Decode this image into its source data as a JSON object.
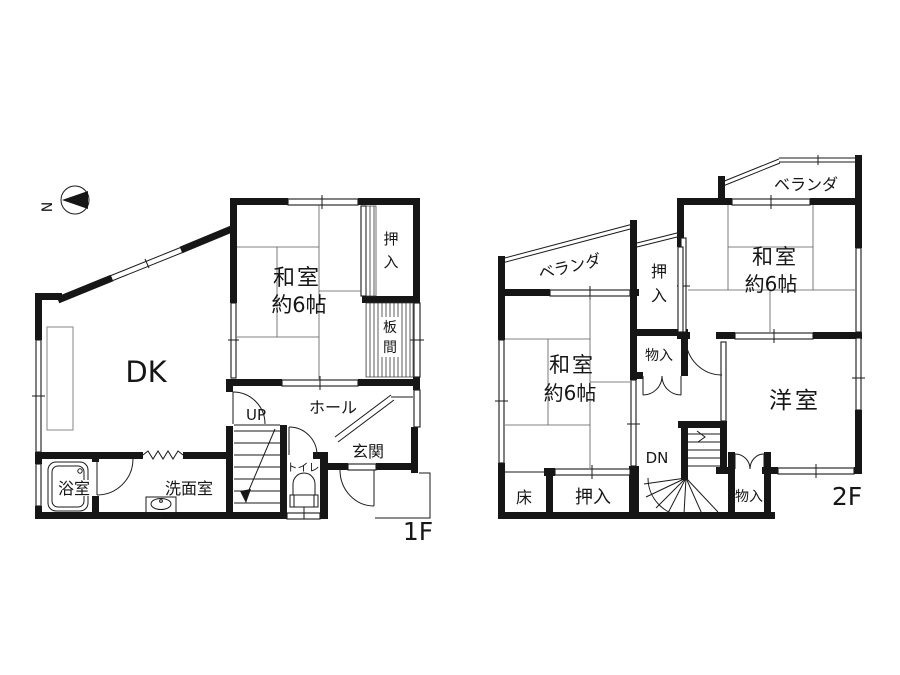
{
  "diagram_type": "floor-plan",
  "compass": {
    "north": "N"
  },
  "colors": {
    "wall": "#161616",
    "thin_line": "#1a1a1a",
    "tatami_line": "#5a5a5a",
    "counter_gray": "#9a9a9a",
    "background": "#ffffff"
  },
  "floor_1f": {
    "label": "1F",
    "washitsu": {
      "name": "和室",
      "size": "約6帖"
    },
    "oshiire": {
      "char_1": "押",
      "char_2": "入"
    },
    "itanoma": {
      "char_1": "板",
      "char_2": "間"
    },
    "dk": "DK",
    "hall": "ホール",
    "genkan": "玄関",
    "toilet": "トイレ",
    "bath": "浴室",
    "washroom": "洗面室",
    "stairs_up": "UP"
  },
  "floor_2f": {
    "label": "2F",
    "veranda_left": "ベランダ",
    "veranda_right": "ベランダ",
    "washitsu_left": {
      "name": "和室",
      "size": "約6帖"
    },
    "washitsu_right": {
      "name": "和室",
      "size": "約6帖"
    },
    "oshiire_center": {
      "char_1": "押",
      "char_2": "入"
    },
    "storage_center": "物入",
    "tokonoma": "床",
    "oshiire_bottom": "押入",
    "storage_right": "物入",
    "western_room": "洋室",
    "stairs_down": "DN"
  }
}
